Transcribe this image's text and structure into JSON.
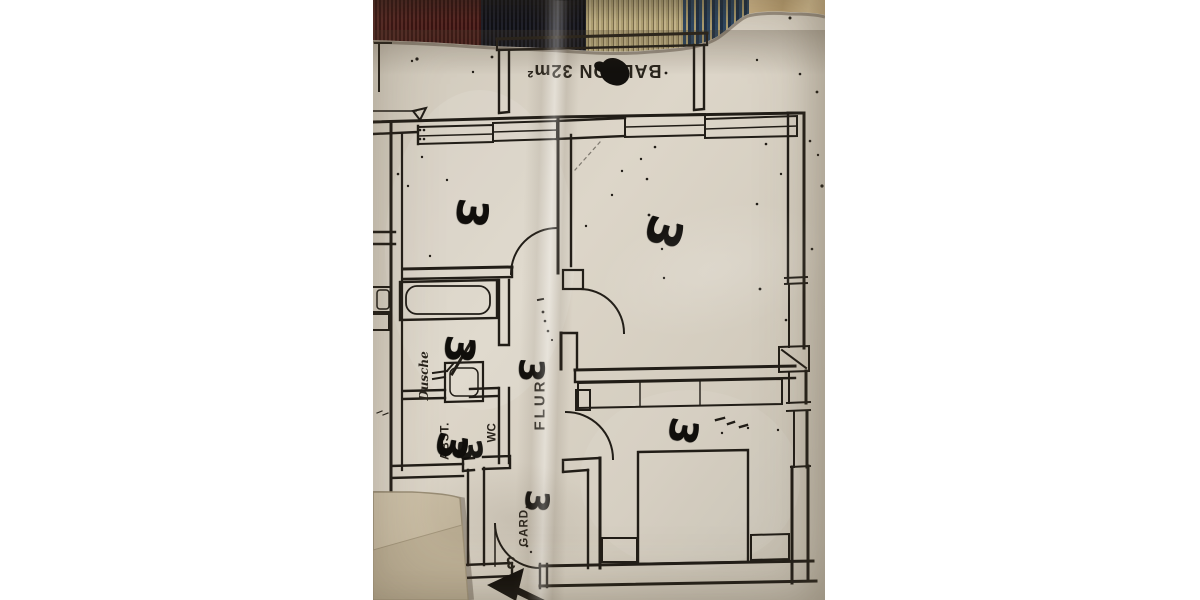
{
  "page": {
    "background": "#ffffff"
  },
  "photo": {
    "rug": {
      "colors": {
        "maroon": "#4e2220",
        "navy": "#181a23",
        "beige_stripe": "#a8996e",
        "blue": "#2c4763",
        "tan": "#c2a87c"
      }
    },
    "paper": {
      "color": "#d7d0c3",
      "ink": "#211d17",
      "overlay_sheet_color": "#c7bba2"
    },
    "plan": {
      "labels": {
        "balcony": "BALKON 32m²",
        "hall": "FLUR",
        "storage": "ABST.",
        "wc": "WC",
        "wardrobe": "GARD.",
        "shower": "Dusche",
        "unit_number": "3"
      },
      "handwritten_marks": [
        "3",
        "3",
        "3",
        "3",
        "3",
        "3",
        "3",
        "3"
      ]
    }
  }
}
